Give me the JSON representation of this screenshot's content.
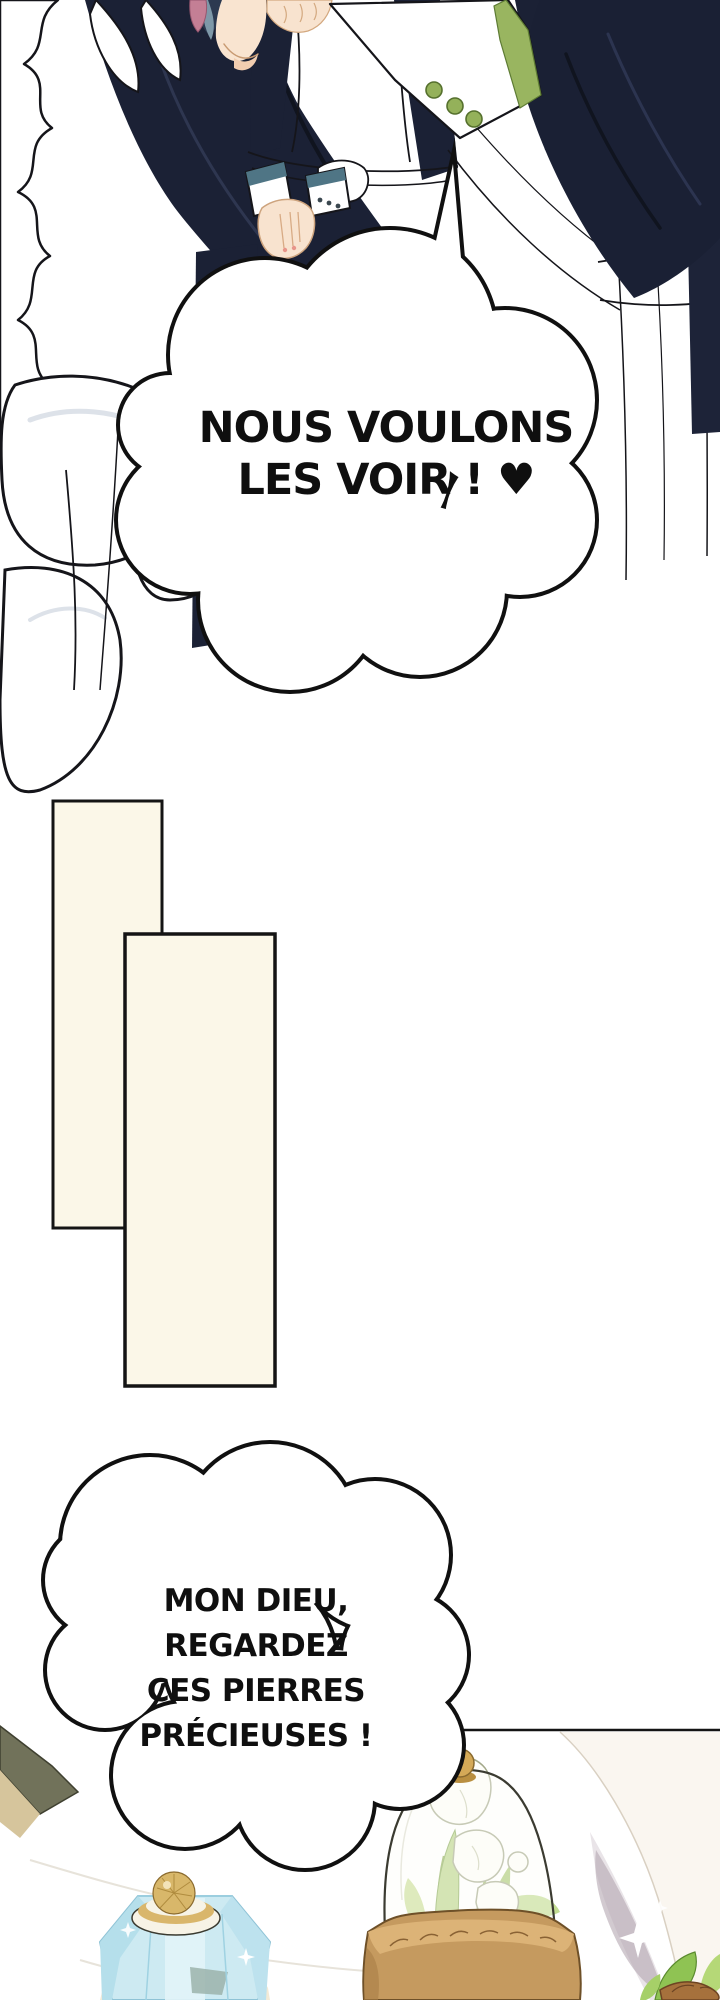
{
  "page": {
    "kind": "webtoon comic page",
    "language": "French",
    "background": "#ffffff",
    "width": 720,
    "height": 2000
  },
  "speech": {
    "bubble1": {
      "shape": "cloud",
      "line1": "NOUS VOULONS",
      "line2": "LES VOIR ! ♥"
    },
    "bubble2": {
      "shape": "cloud",
      "line1": "MON DIEU,",
      "line2": "REGARDEZ",
      "line3": "CES PIERRES",
      "line4": "PRÉCIEUSES !"
    }
  },
  "palette": {
    "outline": "#141414",
    "navy_uniform": "#1b2135",
    "skin": "#f8e3cf",
    "cuff_green": "#99b560",
    "cuff_teal": "#4f7585",
    "hair_pink": "#c47f95",
    "hair_blue": "#7e98a8",
    "panel_cream": "#fbf7e8",
    "bottle_blue": "#cdeaf2",
    "gold": "#d4a957",
    "pot_brown": "#c59a5f",
    "leaf_green": "#a6c871",
    "shadow_lilac": "#b4a6b0"
  },
  "scene": {
    "top": "maids in navy-and-white uniforms, arm with green-trimmed cuff",
    "middle": "two cream panel rectangles",
    "bottom": "marble table with blue crystal bottle, glass cloche of white flowers, white vase"
  }
}
